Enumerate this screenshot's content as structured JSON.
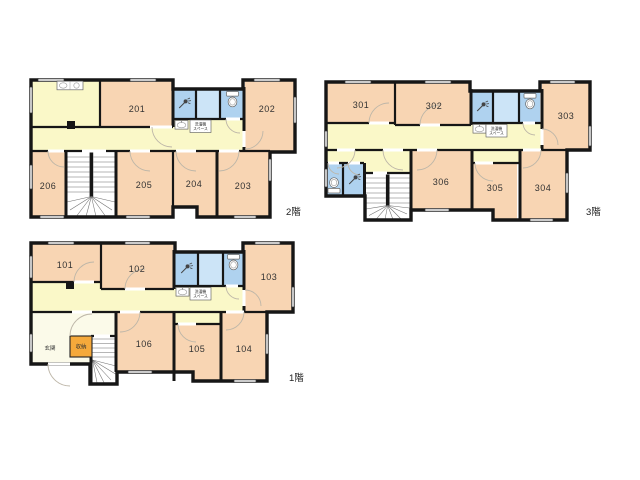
{
  "colors": {
    "room": "#F8D5B3",
    "corr": "#FAF8C8",
    "wet": "#AFD2EF",
    "wetl": "#CCE4F7",
    "ent": "#FBFAE9",
    "sto": "#F5A93B",
    "wall": "#161616"
  },
  "floors": [
    {
      "id": "2f",
      "label": "2階",
      "rooms": [
        "201",
        "202",
        "203",
        "204",
        "205",
        "206"
      ],
      "laundry_space": [
        "洗濯機",
        "スペース"
      ]
    },
    {
      "id": "3f",
      "label": "3階",
      "rooms": [
        "301",
        "302",
        "303",
        "304",
        "305",
        "306"
      ],
      "laundry_space": [
        "洗濯機",
        "スペース"
      ]
    },
    {
      "id": "1f",
      "label": "1階",
      "rooms": [
        "101",
        "102",
        "103",
        "104",
        "105",
        "106"
      ],
      "laundry_space": [
        "洗濯機",
        "スペース"
      ],
      "entrance": "玄関",
      "storage": "収納"
    }
  ],
  "icons": {
    "toilet": "toilet-icon",
    "shower": "shower-icon",
    "washbasin": "washbasin-icon",
    "kitchen": "kitchen-counter-icon",
    "stairs": "staircase"
  }
}
